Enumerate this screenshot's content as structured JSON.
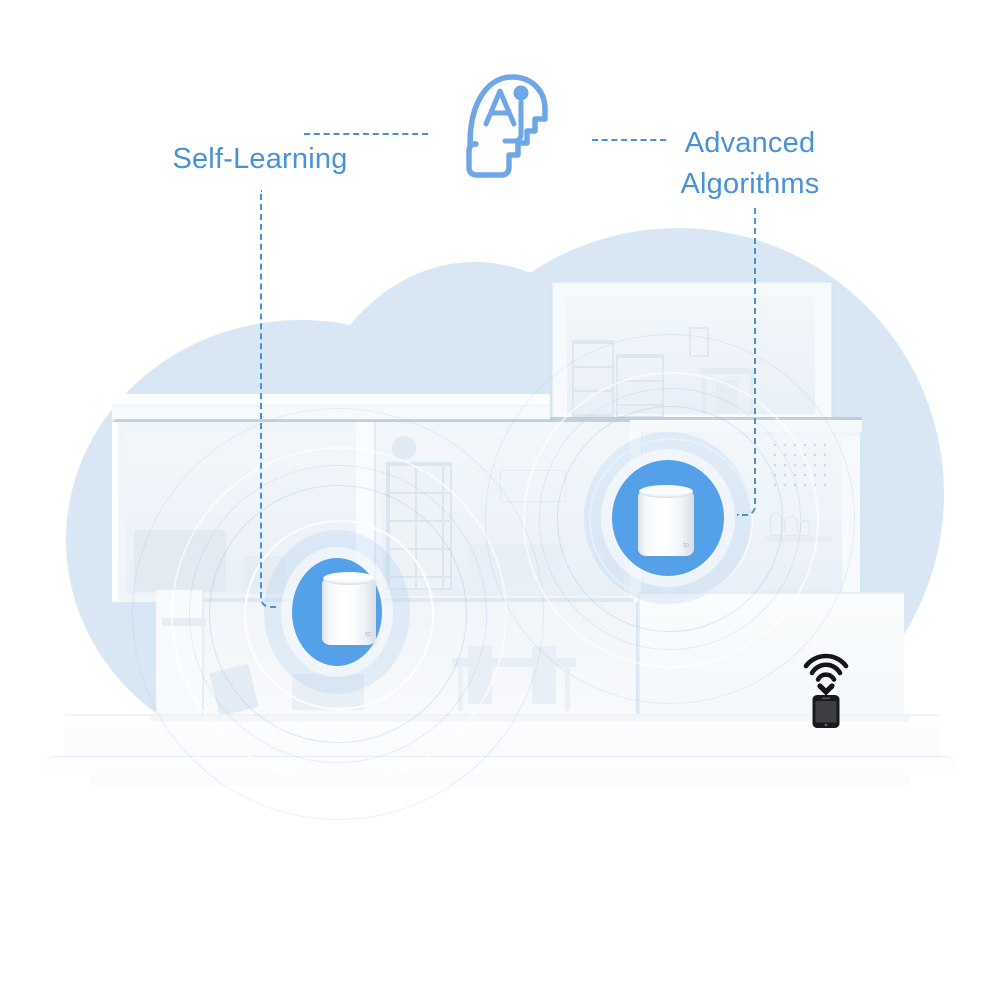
{
  "annotations": {
    "left_label": "Self-Learning",
    "right_label_line1": "Advanced",
    "right_label_line2": "Algorithms"
  },
  "devices": {
    "mesh_unit_count": 2,
    "mesh_unit_logo": "tp",
    "mesh_units": [
      {
        "location": "first-floor-living-room"
      },
      {
        "location": "second-floor-right-room"
      }
    ],
    "client_device": "smartphone-with-wifi-signal"
  },
  "icons": {
    "ai_head": "ai-head-icon",
    "wifi_signal": "wifi-signal-icon",
    "smartphone": "smartphone-icon"
  },
  "colors": {
    "label_text_blue": "#4a92d6",
    "callout_line_blue": "#4a90d5",
    "ai_icon_blue": "#6ea7e7",
    "device_ring_blue": "#54a1e9",
    "cloud_blue": "#d9e7f5",
    "phone_body_black": "#19191b"
  }
}
